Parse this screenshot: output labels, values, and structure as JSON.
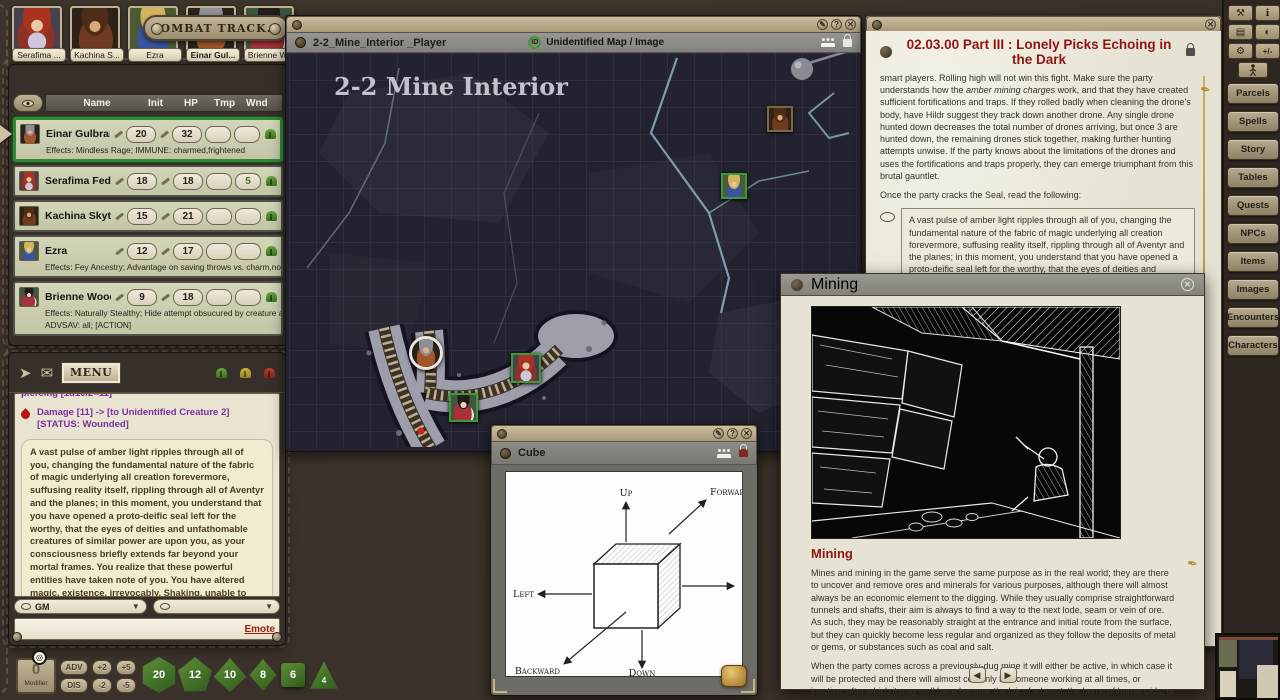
{
  "colors": {
    "accent_active": "#2f8a34",
    "dice_green": "#4c7c2e",
    "chat_purple": "#7b2fa0",
    "heading_red": "#8e1612",
    "parchment": "#e7e3d4",
    "leather": "#3a322a"
  },
  "portraits": [
    {
      "name": "Serafima ..."
    },
    {
      "name": "Kachina S..."
    },
    {
      "name": "Ezra"
    },
    {
      "name": "Einar Gul..."
    },
    {
      "name": "Brienne W..."
    }
  ],
  "combat_tracker": {
    "title": "COMBAT TRACK...",
    "columns": {
      "name": "Name",
      "init": "Init",
      "hp": "HP",
      "tmp": "Tmp",
      "wnd": "Wnd"
    },
    "rows": [
      {
        "name": "Einar Gulbrand",
        "init": "20",
        "hp": "32",
        "tmp": "",
        "wnd": "",
        "effects": "Effects: Mindless Rage; IMMUNE: charmed,frightened"
      },
      {
        "name": "Serafima Fedorov",
        "init": "18",
        "hp": "18",
        "tmp": "",
        "wnd": "5",
        "effects": ""
      },
      {
        "name": "Kachina Skytalon",
        "init": "15",
        "hp": "21",
        "tmp": "",
        "wnd": "",
        "effects": ""
      },
      {
        "name": "Ezra",
        "init": "12",
        "hp": "17",
        "tmp": "",
        "wnd": "",
        "effects": "Effects: Fey Ancestry; Advantage on saving throws vs. charm,no ma"
      },
      {
        "name": "Brienne Wood",
        "init": "9",
        "hp": "18",
        "tmp": "",
        "wnd": "",
        "effects": "Effects: Naturally Stealthy; Hide attempt obsucured by creature at l",
        "effects2": "ADVSAV: all; [ACTION]"
      }
    ]
  },
  "chat": {
    "menu_label": "MENU",
    "partial_line": "piercing [1d10/2=11]",
    "damage_line": "Damage [11] -> [to Unidentified Creature 2] [STATUS: Wounded]",
    "story_text": "A vast pulse of amber light ripples through all of you, changing the fundamental nature of the fabric of magic underlying all creation forevermore, suffusing reality itself, rippling through all of Aventyr and the planes; in this moment, you understand that you have opened a proto-deific seal left for the worthy, that the eyes of deities and unfathomable creatures of similar power are upon you, as your consciousness briefly extends far beyond your mortal frames. You realize that these powerful entities have taken note of you. You have altered magic, existence, irrevocably. Shaking, unable to move, you see a silhouette of a humanoid shape emerging, gliding off into the Underworld. As you regain your senses, the spellcasters among you realize that their magic, that all magic, has changed.",
    "speaker_dropdown": "GM",
    "emote_label": "Emote"
  },
  "map_window": {
    "title": "2-2_Mine_Interior _Player",
    "id_badge": "ID",
    "id_label": "Unidentified Map / Image",
    "map_title": "2-2 Mine Interior"
  },
  "cube_window": {
    "title": "Cube",
    "labels": {
      "up": "Up",
      "down": "Down",
      "left": "Left",
      "right": "Right",
      "forward": "Forward",
      "backward": "Backward"
    }
  },
  "story_window": {
    "title": "02.03.00 Part III : Lonely Picks Echoing in the Dark",
    "para1a": "smart players. Rolling high will not win this fight. Make sure the party understands how the ",
    "para1_italic": "amber mining charges",
    "para1b": " work, and that they have created sufficient fortifications and traps. If they rolled badly when cleaning the drone's body, have Hildr suggest they track down another drone. Any single drone hunted down decreases the total number of drones arriving, but once 3 are hunted down, the remaining drones stick together, making further hunting attempts unwise. If the party knows about the limitations of the drones and uses the fortifications and traps properly, they can emerge triumphant from this brutal gauntlet.",
    "para2": "Once the party cracks the Seal, read the following:",
    "readaloud": "A vast pulse of amber light ripples through all of you, changing the fundamental nature of the fabric of magic underlying all creation forevermore, suffusing reality itself, rippling through all of Aventyr and the planes; in this moment, you understand that you have opened a proto-deific seal left for the worthy, that the eyes of deities and unfathomable creatures of similar power are upon you, as your consciousness briefly extends far beyond your mortal frames. You realize that these powerful entities have taken note of you. You have altered magic, existence, irrevocably. Shaking, unable to move, you see a silhouette of a humanoid shape emerging, gliding off into the Underworld. As you regain your senses, the spellcasters among you realize that their magic, that all magic, has changed."
  },
  "mining_window": {
    "title": "Mining",
    "heading": "Mining",
    "para1": "Mines and mining in the game serve the same purpose as in the real world; they are there to uncover and remove ores and minerals for various purposes, although there will almost always be an economic element to the digging. While they usually comprise straightforward tunnels and shafts, their aim is always to find a way to the next lode, seam or vein of ore. As such, they may be reasonably straight at the entrance and initial route from the surface, but they can quickly become less regular and organized as they follow the deposits of metal or gems, or substances such as coal and salt.",
    "para2": "When the party comes across a previously-dug mine it will either be active, in which case it will be protected and there will almost certainly be someone working at all times, or inactive, after which it may well have become the lair of a beast, the home of humanoids, or the resting place of undead, depending"
  },
  "sidebar": {
    "top_icons": [
      {
        "name": "tools-icon",
        "glyph": "⚒"
      },
      {
        "name": "info-icon",
        "glyph": "ℹ"
      },
      {
        "name": "book-icon",
        "glyph": "▤"
      },
      {
        "name": "masks-icon",
        "glyph": "◐"
      },
      {
        "name": "gear-icon",
        "glyph": "⚙"
      },
      {
        "name": "modifiers-icon",
        "glyph": "+/-"
      }
    ],
    "buttons": [
      "Parcels",
      "Spells",
      "Story",
      "Tables",
      "Quests",
      "NPCs",
      "Items",
      "Images",
      "Encounters",
      "Characters"
    ]
  },
  "dice_bar": {
    "modifier_value": "0",
    "modifier_label": "Modifier",
    "buttons": {
      "adv": "ADV",
      "dis": "DIS",
      "p2": "+2",
      "m2": "-2",
      "p5": "+5",
      "m5": "-5"
    },
    "dice": [
      "20",
      "12",
      "10",
      "8",
      "6",
      "4"
    ]
  }
}
